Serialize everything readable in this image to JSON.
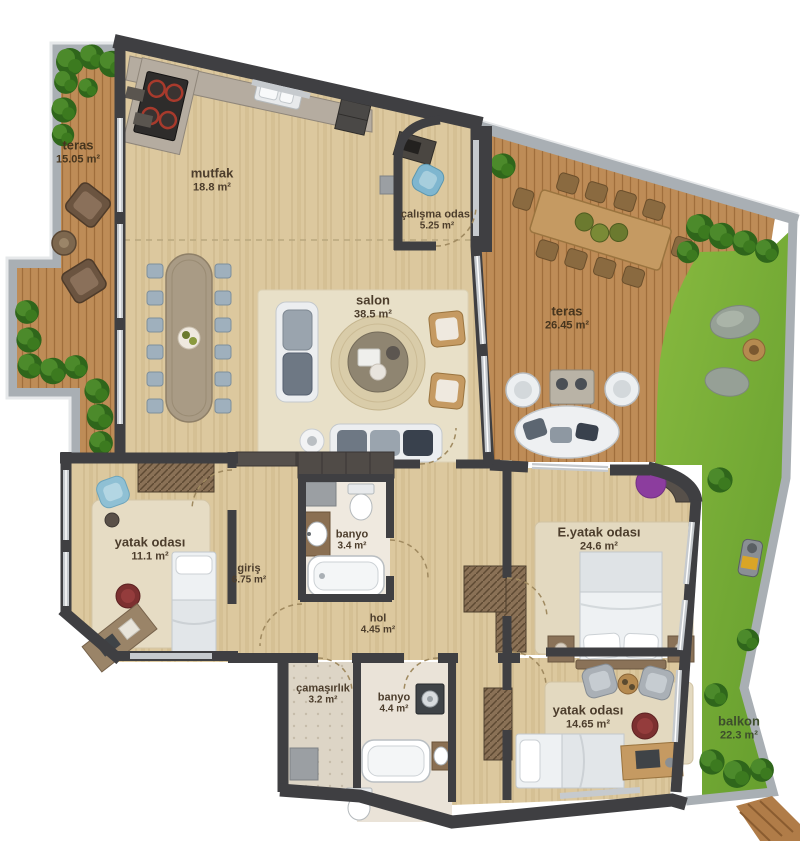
{
  "plan_title": "apartment floor plan",
  "rooms": [
    {
      "name": "teras",
      "area": "15.05 m²"
    },
    {
      "name": "mutfak",
      "area": "18.8 m²"
    },
    {
      "name": "çalışma odası",
      "area": "5.25 m²"
    },
    {
      "name": "salon",
      "area": "38.5 m²"
    },
    {
      "name": "teras",
      "area": "26.45 m²"
    },
    {
      "name": "yatak odası",
      "area": "11.1 m²"
    },
    {
      "name": "giriş",
      "area": "6.75 m²"
    },
    {
      "name": "banyo",
      "area": "3.4 m²"
    },
    {
      "name": "E.yatak odası",
      "area": "24.6 m²"
    },
    {
      "name": "hol",
      "area": "4.45 m²"
    },
    {
      "name": "çamaşırlık",
      "area": "3.2 m²"
    },
    {
      "name": "banyo",
      "area": "4.4 m²"
    },
    {
      "name": "yatak odası",
      "area": "14.65 m²"
    },
    {
      "name": "balkon",
      "area": "22.3 m²"
    }
  ],
  "palette": {
    "wall": "#3f3f42",
    "wood_floor": "#dcc89e",
    "deck_wood": "#be8c57",
    "grass": "#76ab35",
    "rug": "#e8e0c8",
    "parapet": "#a9afb4",
    "window": "#c6cace",
    "accent_blue": "#7fb6cf",
    "accent_purple": "#8c3d9e",
    "accent_maroon": "#7c3030",
    "stove_burner": "#c0452f"
  }
}
